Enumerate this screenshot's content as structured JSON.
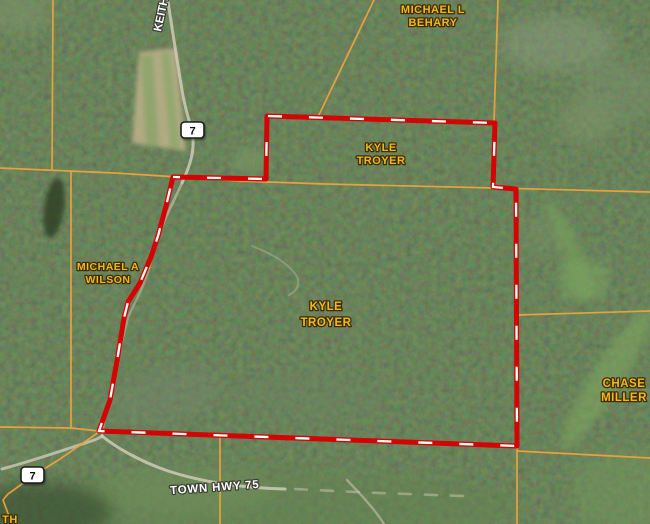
{
  "map": {
    "view": "satellite-parcel-map",
    "owner_labels": [
      {
        "id": "behary",
        "line1": "MICHAEL L",
        "line2": "BEHARY"
      },
      {
        "id": "troyer-north",
        "line1": "KYLE",
        "line2": "TROYER"
      },
      {
        "id": "troyer-main",
        "line1": "KYLE",
        "line2": "TROYER"
      },
      {
        "id": "wilson",
        "line1": "MICHAEL A",
        "line2": "WILSON"
      },
      {
        "id": "miller",
        "line1": "CHASE",
        "line2": "MILLER"
      },
      {
        "id": "partial-southwest",
        "line1": "TH",
        "line2": ""
      }
    ],
    "road_labels": [
      {
        "id": "keith-road",
        "text": "KEITH"
      },
      {
        "id": "town-hwy-75",
        "text": "TOWN HWY 75"
      }
    ],
    "highway_shields": [
      {
        "id": "shield-north",
        "number": "7"
      },
      {
        "id": "shield-south",
        "number": "7"
      }
    ],
    "colors": {
      "selected_parcel_outline": "#d40404",
      "selected_parcel_dash": "#ffffff",
      "parcel_boundary_lines": "#efa33b",
      "owner_label_fill": "#f2b81d",
      "owner_label_outline": "#3d2d05",
      "road_label_fill": "#ffffff",
      "road_label_outline": "#3a3a34",
      "forest_base": "#31492c"
    }
  }
}
